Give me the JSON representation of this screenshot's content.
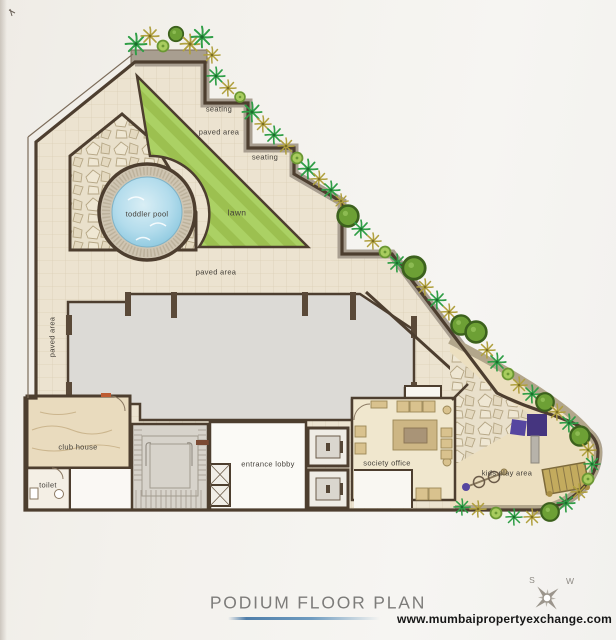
{
  "page": {
    "title": "PODIUM FLOOR PLAN",
    "website": "www.mumbaipropertyexchange.com"
  },
  "compass": {
    "s": "S",
    "w": "W"
  },
  "plan_labels": {
    "seating_upper": "seating",
    "paved_area_top": "paved area",
    "seating_lower": "seating",
    "toddler_pool": "toddler pool",
    "lawn": "lawn",
    "paved_area_middle": "paved area",
    "paved_area_left": "paved area",
    "club_house": "club house",
    "toilet": "toilet",
    "entrance_lobby": "entrance lobby",
    "society_office": "society office",
    "kids_play_area": "kids play area"
  },
  "colors": {
    "wall": "#4d3e2f",
    "paving": "#ece3d0",
    "planter_strip": "#a89e90",
    "lawn_light": "#abd164",
    "lawn_dark": "#9cc050",
    "pool_water": "#9ccfe3",
    "pool_deck": "#cfc5b2",
    "slab": "#dcdad6",
    "club_house": "#e9dbbe",
    "office": "#f0e7ce",
    "sand": "#ecdfc0",
    "play_equipment": "#4f3d96",
    "bench": "#c3ab5e",
    "accent_underline": "#6f9cc0",
    "title_text": "#7d7c7a"
  }
}
